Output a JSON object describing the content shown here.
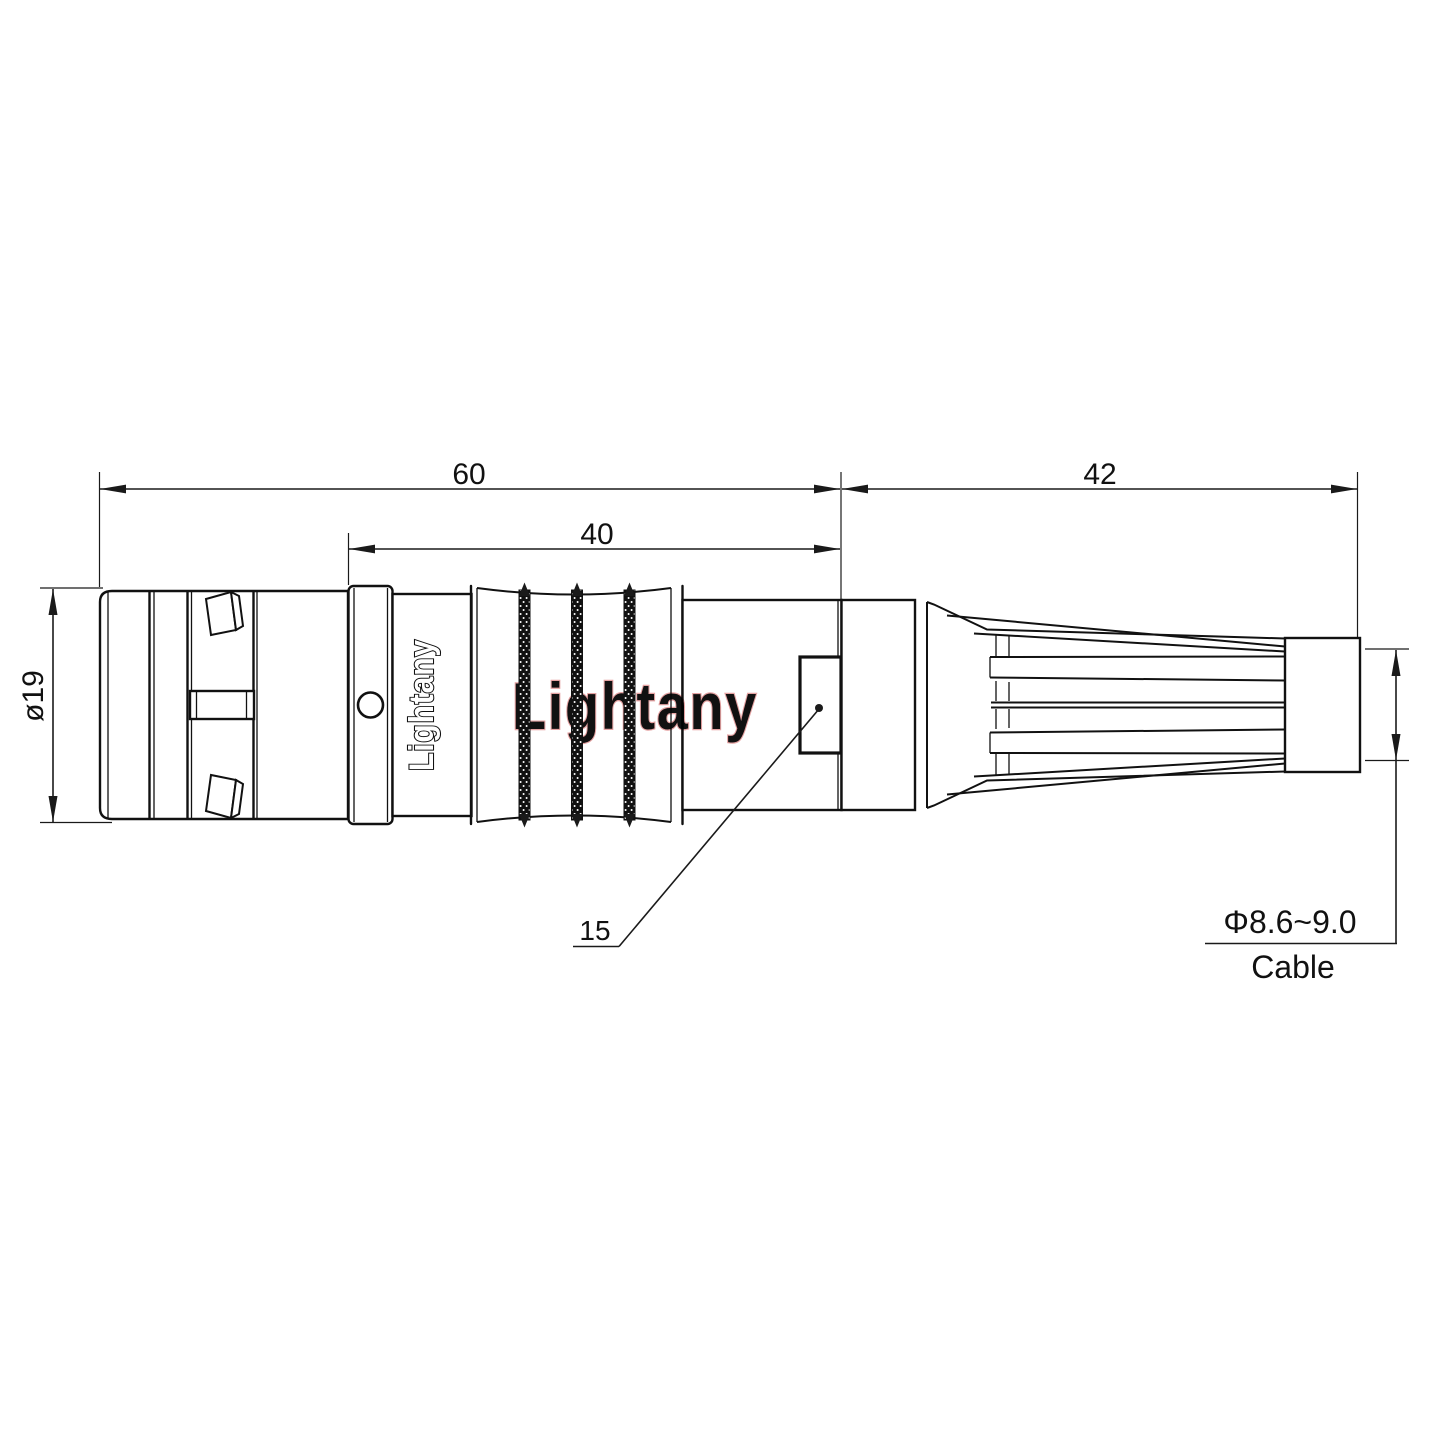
{
  "drawing": {
    "type": "technical-drawing",
    "background": "#ffffff",
    "line_color": "#111111",
    "dims": {
      "total_length": "60",
      "mid_length": "40",
      "boot_length": "42",
      "shell_diameter": "ø19",
      "nut_detail": "15",
      "cable_diameter": "Φ8.6~9.0",
      "cable_label": "Cable"
    },
    "engraving": {
      "text": "Lightany"
    },
    "watermark": {
      "text": "Lightany",
      "fill": "#f7d8d8",
      "stroke": "#e5a2a2"
    }
  }
}
